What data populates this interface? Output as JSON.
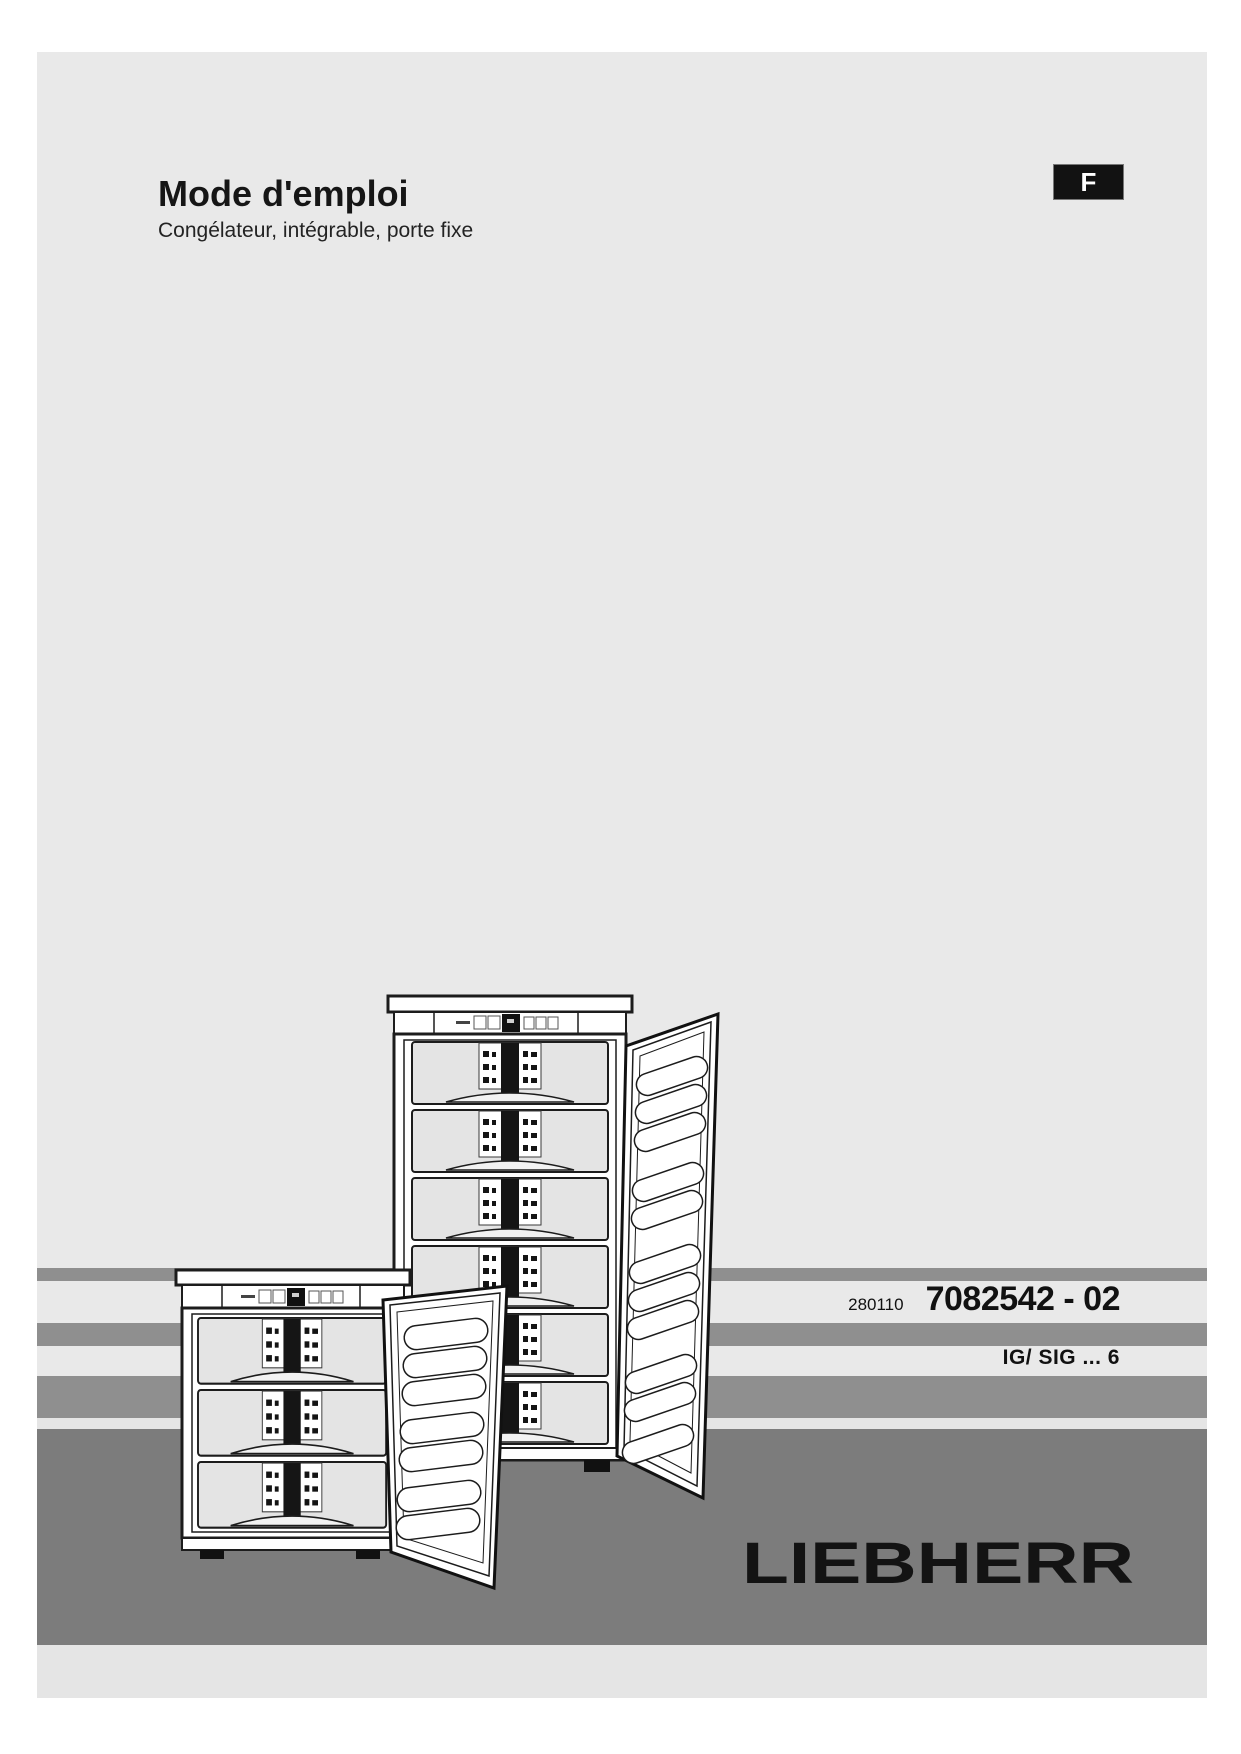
{
  "page": {
    "language_badge": "F",
    "header": {
      "title": "Mode d'emploi",
      "subtitle": "Congélateur, intégrable, porte fixe"
    },
    "print_info": {
      "date_code": "280110",
      "doc_number": "7082542 - 02",
      "model_series": "IG/ SIG ... 6"
    },
    "brand": {
      "logo_text": "LIEBHERR"
    }
  },
  "illustration": {
    "subject": "two built-in freezers with open doors",
    "tall_freezer_drawer_count": 6,
    "small_freezer_drawer_count": 3
  },
  "colors": {
    "page_bg": "#e9e9e9",
    "stripe_gray": "#8f8f8f",
    "floor_gray": "#7c7c7c",
    "badge_bg": "#121212",
    "text": "#111111"
  }
}
